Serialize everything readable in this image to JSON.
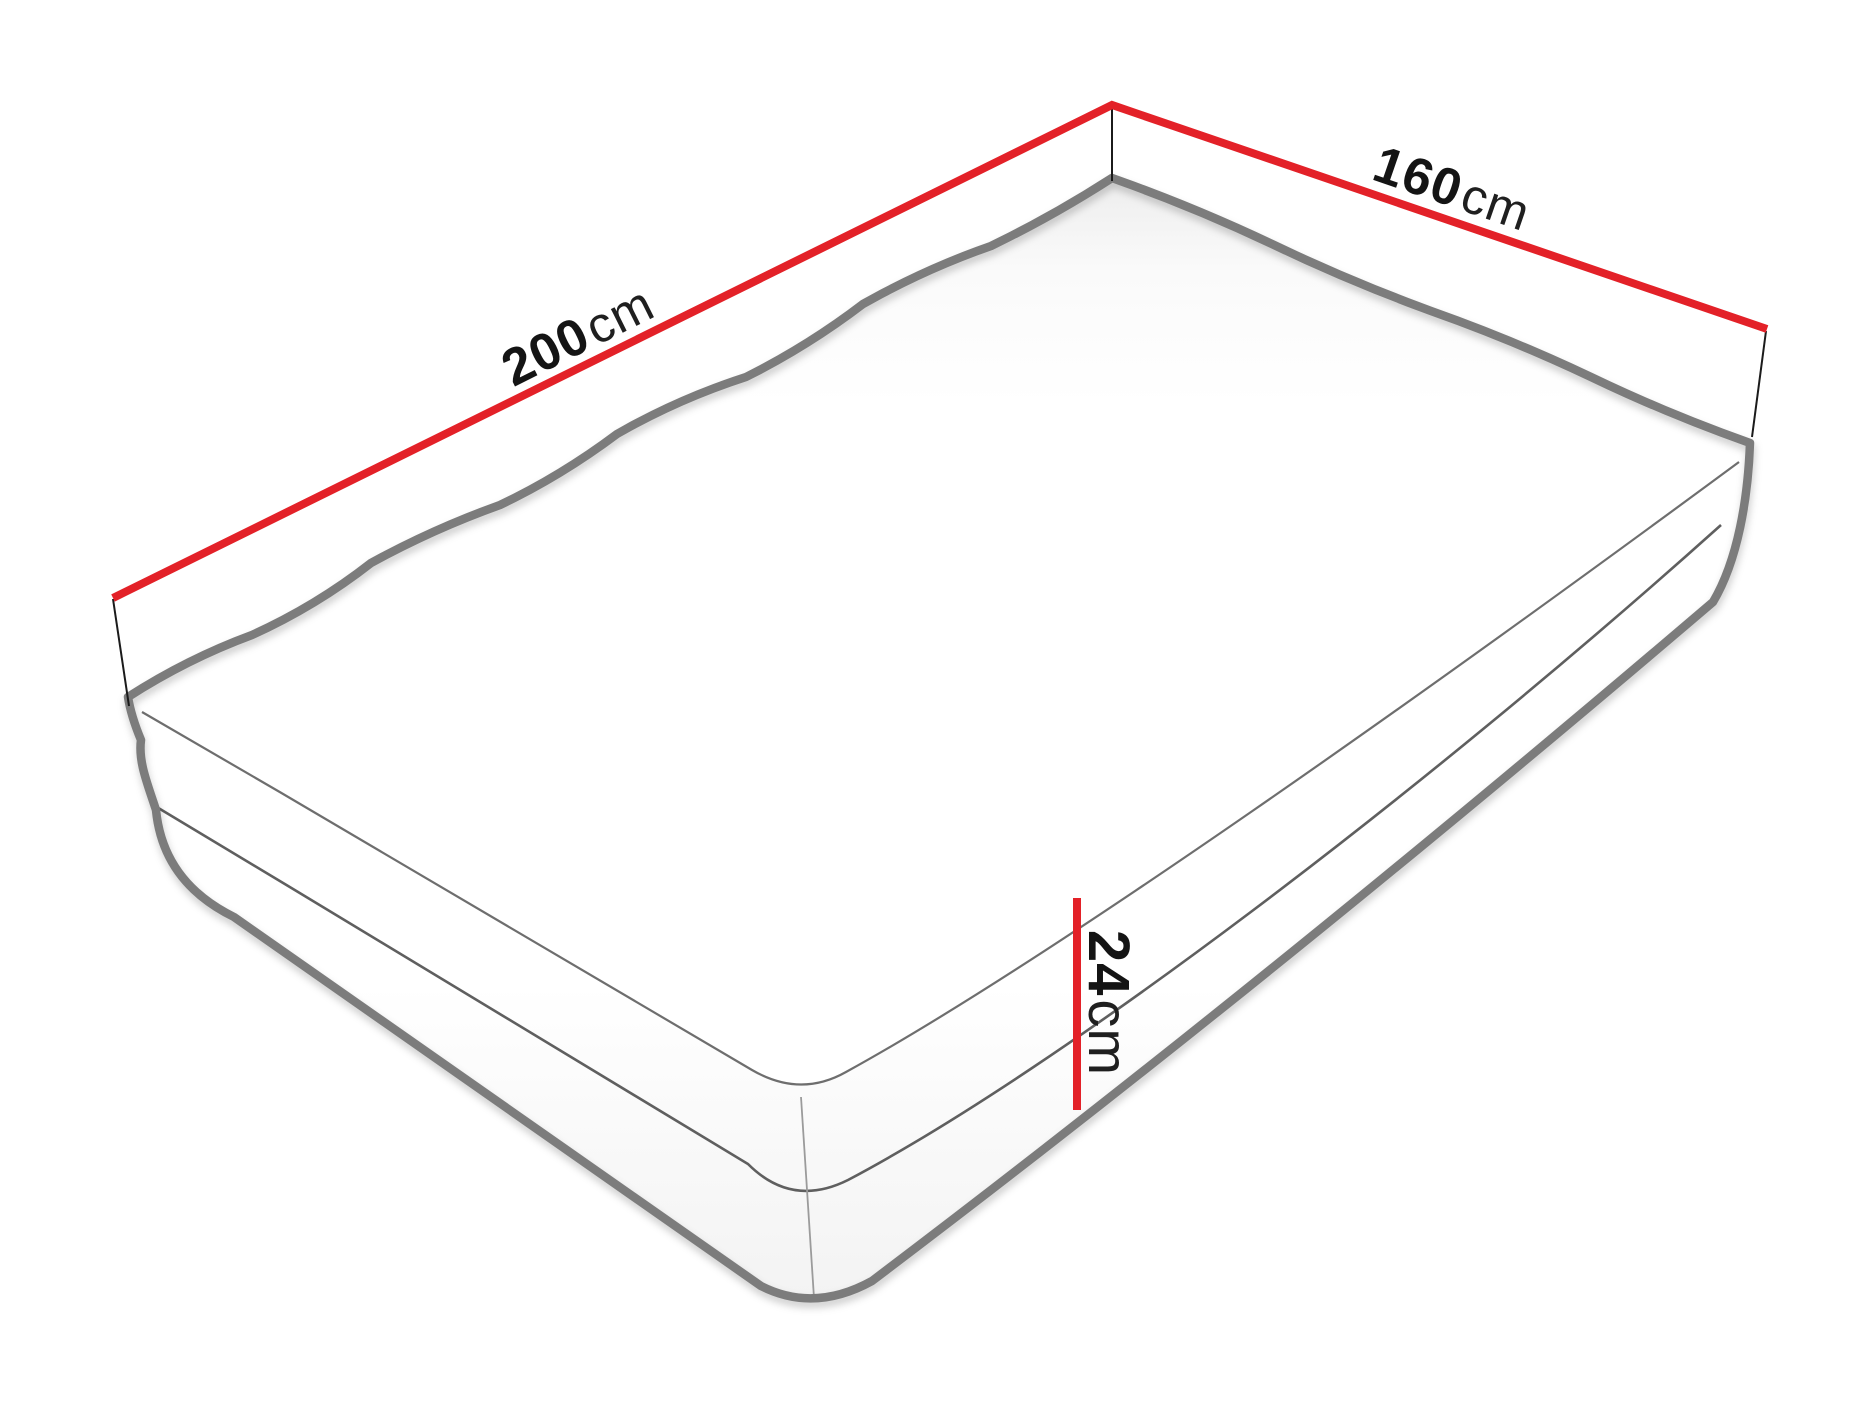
{
  "diagram": {
    "title": "Mattress dimension diagram",
    "background": "#ffffff",
    "labels": {
      "length": {
        "value": "200",
        "unit": "cm"
      },
      "width": {
        "value": "160",
        "unit": "cm"
      },
      "height": {
        "value": "24",
        "unit": "cm"
      }
    },
    "colors": {
      "dimension_line": "#e32128",
      "outline": "#7c7c7c",
      "seam": "#5f5f5f",
      "top_edge": "#6e6e6e",
      "corner_seam": "#9b9b9b",
      "extension_line": "#1b1b1b",
      "text": "#141414"
    }
  }
}
